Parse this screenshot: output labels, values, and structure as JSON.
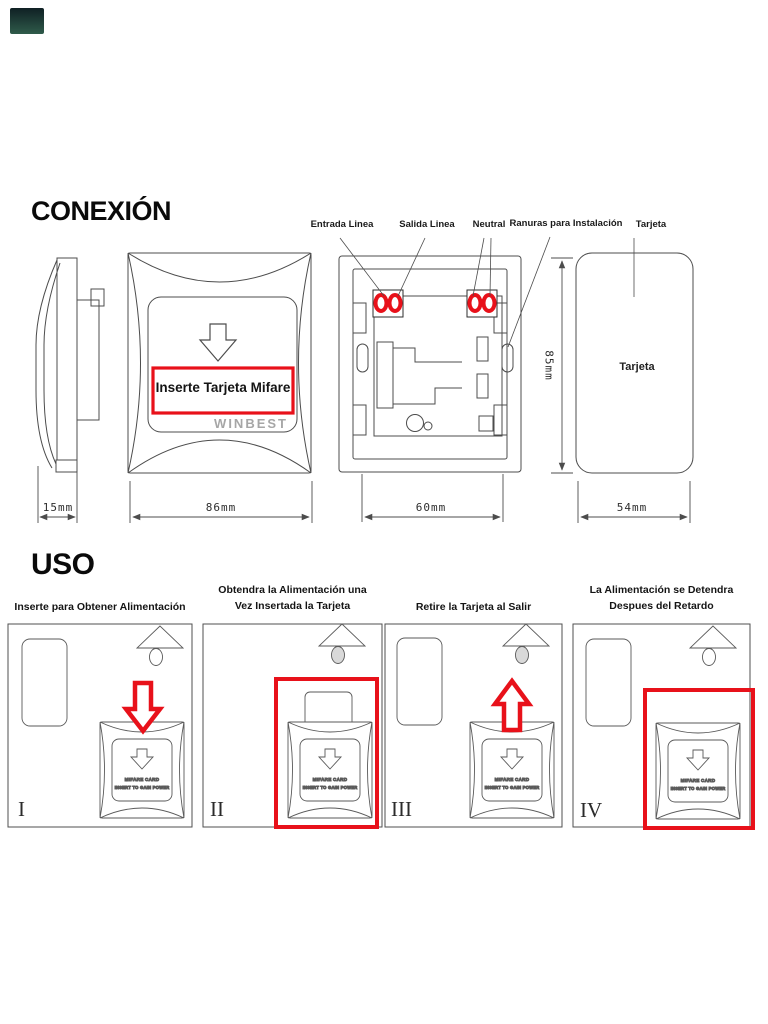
{
  "colors": {
    "accent_red": "#e8111a",
    "line": "#4c4c4c",
    "brand_gray": "#a6a6a6"
  },
  "conexion": {
    "title": "CONEXIÓN",
    "wiring_labels": {
      "entrada": "Entrada Linea",
      "salida": "Salida Linea",
      "neutral": "Neutral",
      "ranuras": "Ranuras para Instalación",
      "tarjeta": "Tarjeta"
    },
    "front_panel": {
      "insert_text": "Inserte Tarjeta Mifare",
      "brand": "WINBEST"
    },
    "card": {
      "label": "Tarjeta"
    },
    "dimensions": {
      "side_depth": "15mm",
      "front_width": "86mm",
      "box_width": "60mm",
      "card_height": "85mm",
      "card_width": "54mm"
    }
  },
  "uso": {
    "title": "USO",
    "steps": [
      {
        "numeral": "I",
        "caption": "Inserte para Obtener Alimentación"
      },
      {
        "numeral": "II",
        "caption": "Obtendra la Alimentación una\nVez Insertada la Tarjeta"
      },
      {
        "numeral": "III",
        "caption": "Retire la Tarjeta al Salir"
      },
      {
        "numeral": "IV",
        "caption": "La Alimentación se Detendra\nDespues del Retardo"
      }
    ],
    "mini_switch": {
      "line1": "MIFARE  CARD",
      "line2": "INSERT TO GAIN POWER"
    }
  }
}
